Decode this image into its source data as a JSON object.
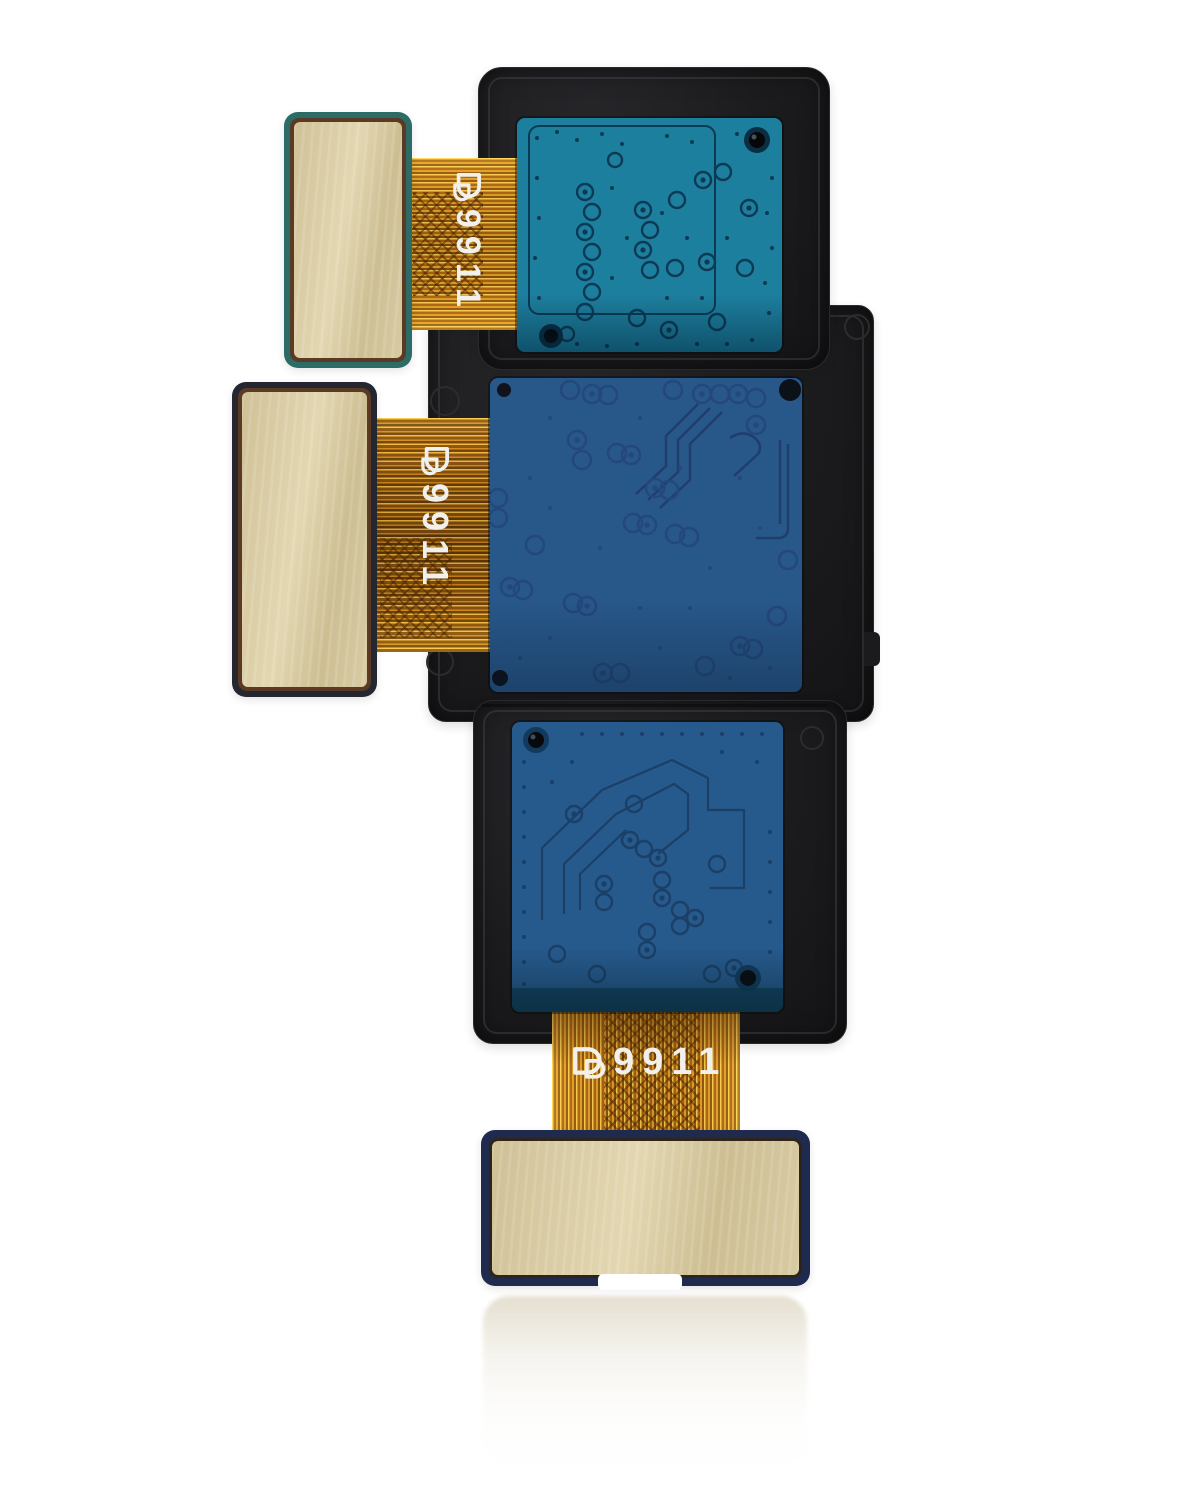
{
  "photo": {
    "subject": "Triple rear camera module flex cable assembly product photo",
    "background_color": "#ffffff"
  },
  "flex_markings": {
    "top": {
      "logo": "double-d-logo",
      "code": "9911"
    },
    "middle": {
      "logo": "double-d-logo",
      "code": "9911"
    },
    "bottom": {
      "logo": "double-d-logo",
      "code": "9911"
    }
  },
  "colors": {
    "housing_black": "#1b1b1d",
    "pcb_top_teal": "#1d7f9e",
    "pcb_middle_blue": "#28588a",
    "pcb_bottom_blue": "#26598c",
    "pcb_trace_dark": "#0c3a55",
    "flex_orange": "#cf8a1e",
    "flex_highlight": "#ffd95e",
    "pad_gold": "#d8cba3",
    "pad_border_teal": "#2d6b66",
    "pad_border_navy": "#1e2a4e",
    "marking_white": "#f2f0ec"
  }
}
